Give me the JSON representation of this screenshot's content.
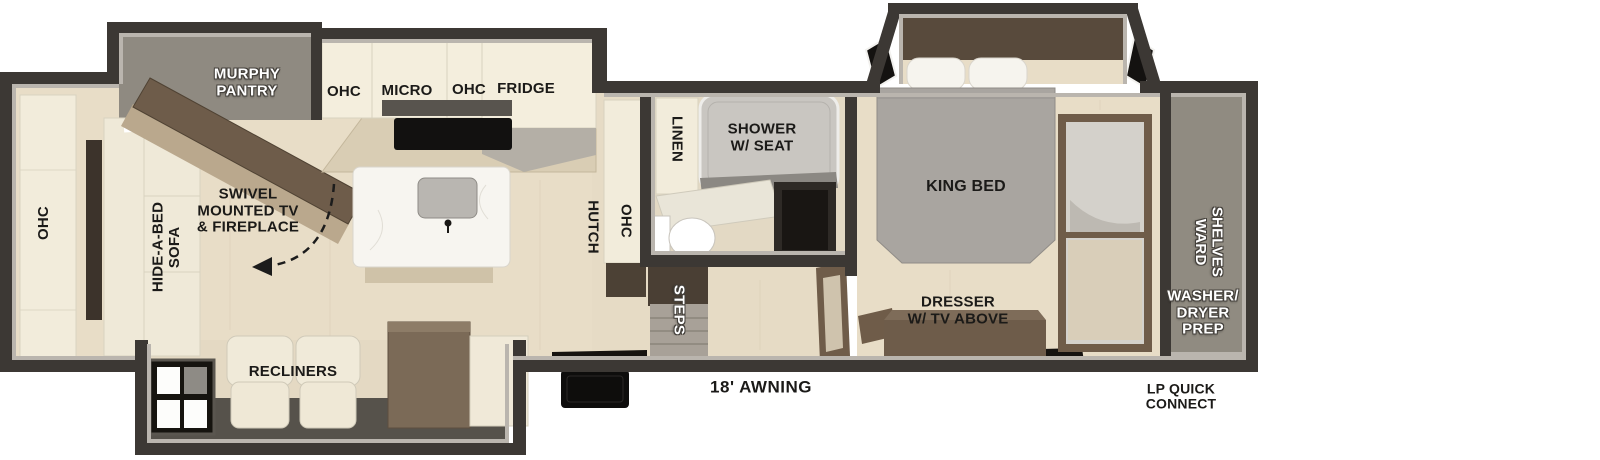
{
  "floorplan": {
    "title": "travel-trailer-floorplan",
    "labels": {
      "murphy_pantry": "MURPHY\nPANTRY",
      "ohc_kitchen_left": "OHC",
      "micro": "MICRO",
      "ohc_kitchen_right": "OHC",
      "fridge": "FRIDGE",
      "swivel_tv": "SWIVEL\nMOUNTED TV\n& FIREPLACE",
      "ohc_rear": "OHC",
      "hide_a_bed_sofa": "HIDE-A-BED\nSOFA",
      "recliners": "RECLINERS",
      "hutch": "HUTCH",
      "ohc_hutch": "OHC",
      "linen": "LINEN",
      "shower": "SHOWER\nW/ SEAT",
      "king_bed": "KING BED",
      "dresser": "DRESSER\nW/ TV ABOVE",
      "steps": "STEPS",
      "shelves_ward": "SHELVES\nWARD",
      "washer_dryer_prep": "WASHER/\nDRYER\nPREP",
      "awning": "18' AWNING",
      "lp_quick_connect": "LP QUICK\nCONNECT"
    },
    "colors": {
      "wall": "#3c3834",
      "wall_lining": "#bab5ae",
      "floor": "#e8ddc7",
      "slide_gray": "#8f8a81",
      "cabinet_cream": "#f3edda",
      "furniture_brown": "#6e5c4a",
      "counter_tan": "#d9cdb4",
      "bed_gray": "#a9a5a0",
      "shower_gray": "#c9c6c1",
      "black": "#141210"
    }
  }
}
